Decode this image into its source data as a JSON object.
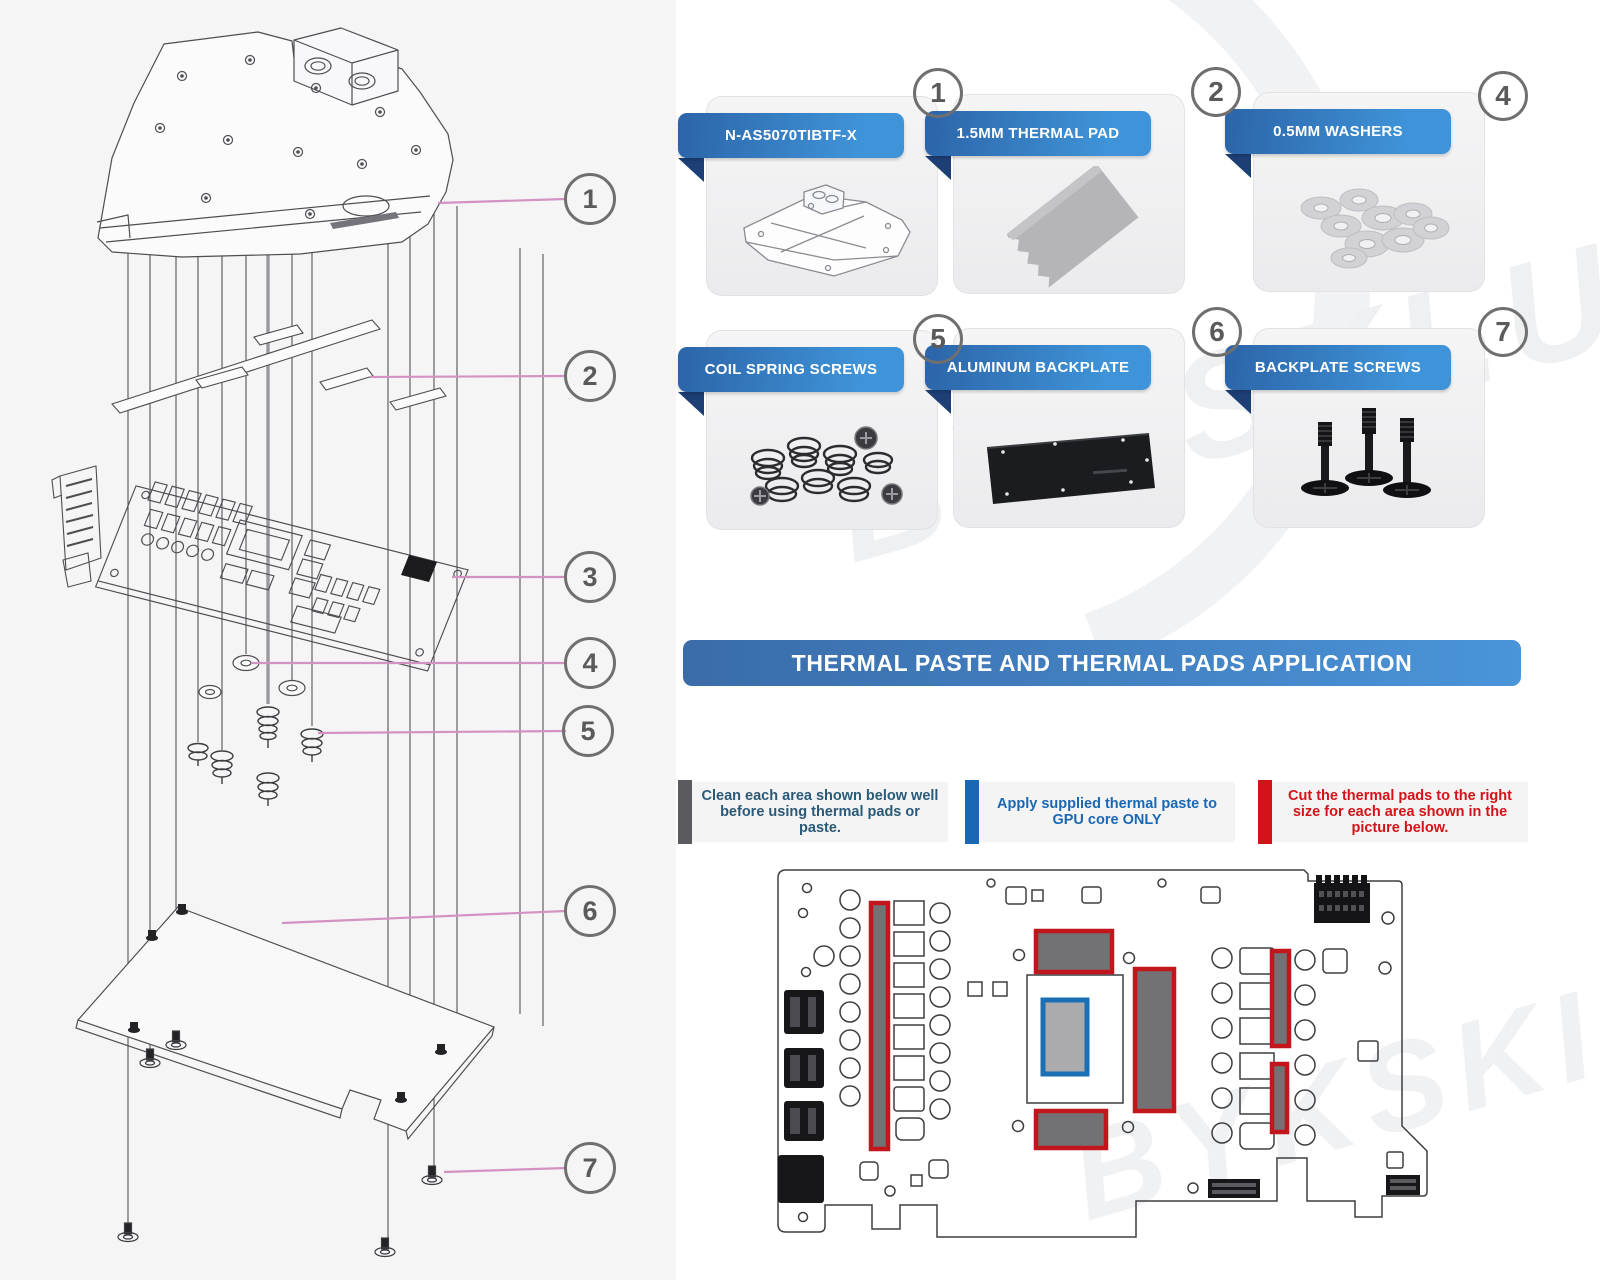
{
  "watermark": {
    "text": "BYKSKI.US"
  },
  "title_banner": {
    "text": "THERMAL PASTE AND THERMAL PADS APPLICATION"
  },
  "parts_cards": [
    {
      "number": "1",
      "label": "N-AS5070TIBTF-X",
      "art": "water-block-illustration"
    },
    {
      "number": "2",
      "label": "1.5MM THERMAL PAD",
      "art": "thermal-pad-illustration"
    },
    {
      "number": "4",
      "label": "0.5MM WASHERS",
      "art": "washers-illustration"
    },
    {
      "number": "5",
      "label": "COIL SPRING SCREWS",
      "art": "coil-spring-screws-illustration"
    },
    {
      "number": "6",
      "label": "ALUMINUM BACKPLATE",
      "art": "aluminum-backplate-illustration"
    },
    {
      "number": "7",
      "label": "BACKPLATE SCREWS",
      "art": "backplate-screws-illustration"
    }
  ],
  "exploded_view": {
    "callouts": [
      {
        "n": "1"
      },
      {
        "n": "2"
      },
      {
        "n": "3"
      },
      {
        "n": "4"
      },
      {
        "n": "5"
      },
      {
        "n": "6"
      },
      {
        "n": "7"
      }
    ]
  },
  "notes": [
    {
      "text": "Clean each area shown below well before using thermal pads or paste.",
      "bar_color": "#5b5b5f",
      "text_color": "#2a5a78"
    },
    {
      "text": "Apply supplied thermal paste to GPU core ONLY",
      "bar_color": "#1a67b3",
      "text_color": "#1a67b3"
    },
    {
      "text": "Cut the thermal pads to the right size for each area shown in the picture below.",
      "bar_color": "#d41319",
      "text_color": "#d41319"
    }
  ],
  "pcb_diagram": {
    "thermal_pad_outline_color": "#c3161c",
    "gpu_core_outline_color": "#1a6fb5",
    "pad_fill_color": "#727275",
    "core_fill_color": "#ababae"
  }
}
